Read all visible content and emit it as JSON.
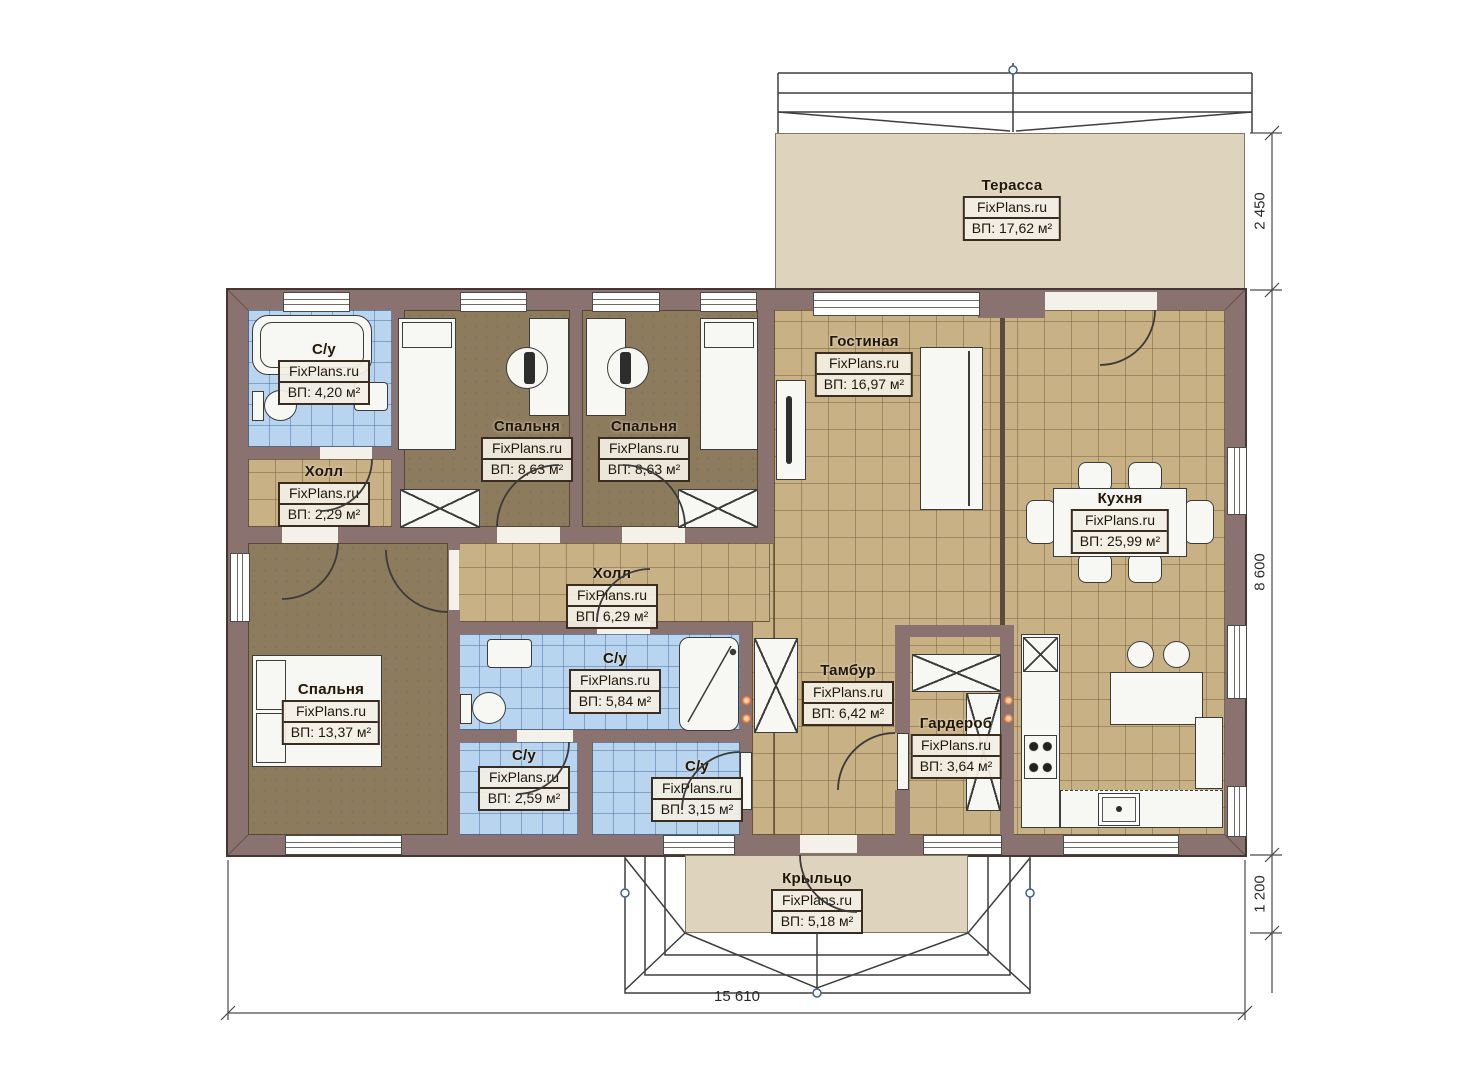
{
  "brand": "FixPlans.ru",
  "rooms": {
    "terrace": {
      "name": "Терасса",
      "area": "ВП: 17,62 м²"
    },
    "bathroom_top": {
      "name": "С/у",
      "area": "ВП: 4,20 м²"
    },
    "hall_small": {
      "name": "Холл",
      "area": "ВП: 2,29 м²"
    },
    "bedroom_1": {
      "name": "Спальня",
      "area": "ВП: 8,63 м²"
    },
    "bedroom_2": {
      "name": "Спальня",
      "area": "ВП: 8,63 м²"
    },
    "living": {
      "name": "Гостиная",
      "area": "ВП: 16,97 м²"
    },
    "kitchen": {
      "name": "Кухня",
      "area": "ВП: 25,99 м²"
    },
    "hall_main": {
      "name": "Холл",
      "area": "ВП: 6,29 м²"
    },
    "bathroom_main": {
      "name": "С/у",
      "area": "ВП: 5,84 м²"
    },
    "bathroom_small": {
      "name": "С/у",
      "area": "ВП: 2,59 м²"
    },
    "bathroom_third": {
      "name": "С/у",
      "area": "ВП: 3,15 м²"
    },
    "tambour": {
      "name": "Тамбур",
      "area": "ВП: 6,42 м²"
    },
    "wardrobe": {
      "name": "Гардероб",
      "area": "ВП: 3,64 м²"
    },
    "bedroom_master": {
      "name": "Спальня",
      "area": "ВП: 13,37 м²"
    },
    "porch": {
      "name": "Крыльцо",
      "area": "ВП: 5,18 м²"
    }
  },
  "dimensions": {
    "terrace_depth": "2 450",
    "house_depth": "8 600",
    "porch_depth": "1 200",
    "house_width": "15 610"
  },
  "colors": {
    "wall": "#8a7270",
    "floor_tile_tan": "#c9b186",
    "floor_wood": "#8d7b5e",
    "floor_tile_blue": "#b9d4ee",
    "terrace_floor": "#ded3bd",
    "label_border": "#3a2c1e"
  }
}
